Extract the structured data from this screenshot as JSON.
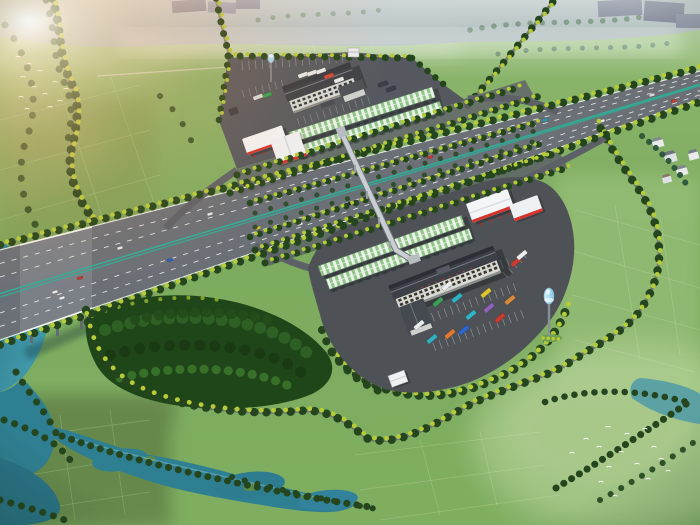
{
  "scene": {
    "description": "Aerial rendering of an expressway service area: diagonal highway, two service complexes with striped canopies and gas stations, forest grove, farmland, ponds and bird flocks",
    "palette": {
      "field_green": "#7dab60",
      "field_pale": "#a9c985",
      "forest_dark": "#1f4619",
      "tree_dark": "#24451d",
      "tree_yellow": "#b5cb37",
      "asphalt_highway": "#6b7076",
      "pavement_upper": "#55595f",
      "pavement_lower": "#4e5257",
      "median_teal": "#2fae97",
      "water_teal": "#2f7f92",
      "canopy_white": "#e8f2e6",
      "canopy_green": "#90c488",
      "gas_white": "#f3f5f7",
      "gas_red": "#d4342c",
      "roof_dark": "#3d4147",
      "wall_light": "#d6d8d4",
      "water_tower_blue": "#a8d8ee",
      "haze_blue": "#93a0b2",
      "sun_glow": "#ff9f58"
    }
  },
  "highway": {
    "vehicles": [
      {
        "x": 55,
        "y": 292,
        "c": "#e8e8e8"
      },
      {
        "x": 80,
        "y": 278,
        "c": "#c83830"
      },
      {
        "x": 62,
        "y": 298,
        "c": "#e8e8e8"
      },
      {
        "x": 120,
        "y": 248,
        "c": "#e8e8e8"
      },
      {
        "x": 170,
        "y": 260,
        "c": "#2a62c8"
      },
      {
        "x": 210,
        "y": 214,
        "c": "#e8e8e8"
      },
      {
        "x": 258,
        "y": 228,
        "c": "#d8c22e"
      },
      {
        "x": 300,
        "y": 224,
        "c": "#e8e8e8"
      },
      {
        "x": 332,
        "y": 179,
        "c": "#e8e8e8"
      },
      {
        "x": 348,
        "y": 204,
        "c": "#22282e"
      },
      {
        "x": 430,
        "y": 157,
        "c": "#c83830"
      },
      {
        "x": 488,
        "y": 160,
        "c": "#e8e8e8"
      },
      {
        "x": 545,
        "y": 120,
        "c": "#2aa0b8"
      },
      {
        "x": 602,
        "y": 121,
        "c": "#e8e8e8"
      },
      {
        "x": 652,
        "y": 95,
        "c": "#d8d8d8"
      },
      {
        "x": 674,
        "y": 101,
        "c": "#c8402e"
      }
    ]
  },
  "upper_area": {
    "trucks": [
      {
        "x": 303,
        "y": 75,
        "c": "#e8eaea"
      },
      {
        "x": 312,
        "y": 73,
        "c": "#e8eaea"
      },
      {
        "x": 321,
        "y": 71,
        "c": "#e8eaea"
      },
      {
        "x": 329,
        "y": 76,
        "c": "#cc4a38"
      },
      {
        "x": 339,
        "y": 80,
        "c": "#e8eaea"
      },
      {
        "x": 267,
        "y": 95,
        "c": "#3a9e54"
      },
      {
        "x": 383,
        "y": 84,
        "c": "#3a4048"
      },
      {
        "x": 391,
        "y": 89,
        "c": "#3a4048"
      },
      {
        "x": 258,
        "y": 97,
        "c": "#d8dadc"
      }
    ]
  },
  "lower_area": {
    "buses": [
      {
        "x": 447,
        "y": 286,
        "c": "#e9ebec"
      },
      {
        "x": 457,
        "y": 298,
        "c": "#2fb3c4"
      },
      {
        "x": 438,
        "y": 302,
        "c": "#3a9e54"
      },
      {
        "x": 486,
        "y": 293,
        "c": "#ddc52f"
      },
      {
        "x": 489,
        "y": 308,
        "c": "#9061b6"
      },
      {
        "x": 471,
        "y": 315,
        "c": "#2fb3c4"
      },
      {
        "x": 500,
        "y": 318,
        "c": "#cc3b2f"
      },
      {
        "x": 464,
        "y": 330,
        "c": "#2d66cc"
      },
      {
        "x": 450,
        "y": 334,
        "c": "#e0782f"
      },
      {
        "x": 432,
        "y": 339,
        "c": "#31b0bf"
      },
      {
        "x": 419,
        "y": 325,
        "c": "#e9ebec"
      },
      {
        "x": 510,
        "y": 300,
        "c": "#d8893a"
      },
      {
        "x": 516,
        "y": 262,
        "c": "#cc3b2f"
      },
      {
        "x": 522,
        "y": 255,
        "c": "#e9ebec"
      }
    ]
  },
  "birds": {
    "positions": [
      [
        18,
        56
      ],
      [
        29,
        63
      ],
      [
        23,
        76
      ],
      [
        40,
        70
      ],
      [
        34,
        86
      ],
      [
        21,
        96
      ],
      [
        45,
        93
      ],
      [
        55,
        81
      ],
      [
        50,
        106
      ],
      [
        27,
        108
      ],
      [
        60,
        100
      ],
      [
        66,
        88
      ],
      [
        608,
        426
      ],
      [
        627,
        433
      ],
      [
        645,
        428
      ],
      [
        599,
        446
      ],
      [
        621,
        451
      ],
      [
        654,
        446
      ],
      [
        609,
        466
      ],
      [
        637,
        463
      ],
      [
        661,
        458
      ],
      [
        648,
        478
      ],
      [
        601,
        481
      ],
      [
        668,
        470
      ],
      [
        615,
        495
      ],
      [
        586,
        438
      ],
      [
        572,
        452
      ]
    ]
  }
}
